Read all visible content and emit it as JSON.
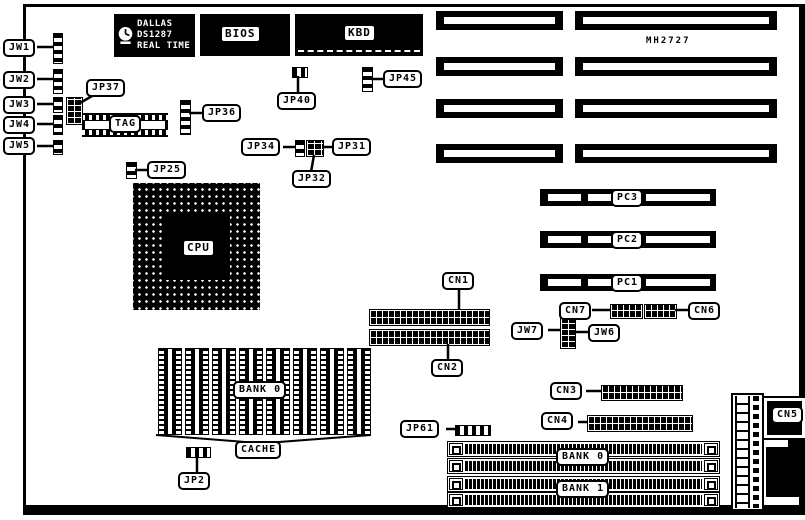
{
  "board": {
    "rtc_chip": {
      "line1": "DALLAS",
      "line2": "DS1287",
      "line3": "REAL TIME"
    },
    "chips": {
      "bios": "BIOS",
      "kbd": "KBD",
      "tag": "TAG",
      "cpu": "CPU",
      "mh2727": "MH2727"
    },
    "jumpers": {
      "jw1": "JW1",
      "jw2": "JW2",
      "jw3": "JW3",
      "jw4": "JW4",
      "jw5": "JW5",
      "jw6": "JW6",
      "jw7": "JW7",
      "jp2": "JP2",
      "jp25": "JP25",
      "jp31": "JP31",
      "jp32": "JP32",
      "jp34": "JP34",
      "jp36": "JP36",
      "jp37": "JP37",
      "jp40": "JP40",
      "jp45": "JP45",
      "jp61": "JP61"
    },
    "connectors": {
      "cn1": "CN1",
      "cn2": "CN2",
      "cn3": "CN3",
      "cn4": "CN4",
      "cn5": "CN5",
      "cn6": "CN6",
      "cn7": "CN7",
      "pc1": "PC1",
      "pc2": "PC2",
      "pc3": "PC3"
    },
    "memory": {
      "cache_bank": "BANK 0",
      "cache": "CACHE",
      "bank0": "BANK 0",
      "bank1": "BANK 1"
    },
    "colors": {
      "ink": "#000000",
      "bg": "#ffffff"
    }
  }
}
